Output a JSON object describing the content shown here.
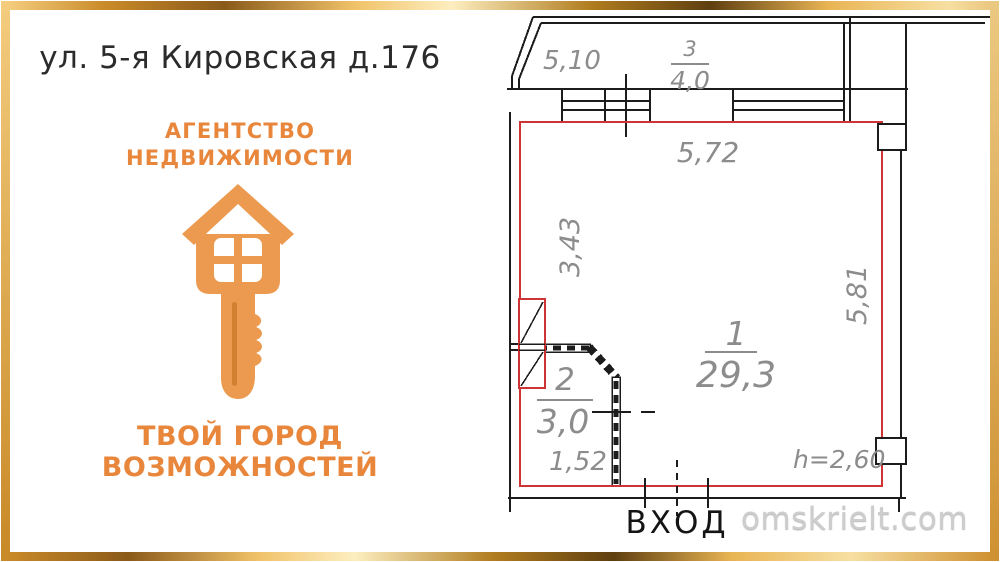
{
  "address": "ул. 5-я Кировская д.176",
  "agency": {
    "line1": "АГЕНТСТВО",
    "line2": "НЕДВИЖИМОСТИ",
    "slogan1": "ТВОЙ ГОРОД",
    "slogan2": "ВОЗМОЖНОСТЕЙ",
    "accent_color": "#e8873c",
    "logo_color": "#eb9a50"
  },
  "floorplan": {
    "outline_color": "#cf3434",
    "line_color": "#1c1c1c",
    "dim_color": "#8c8c8c",
    "rooms": [
      {
        "number": "1",
        "area": "29,3"
      },
      {
        "number": "2",
        "area": "3,0"
      },
      {
        "number": "3",
        "area": "4,0"
      }
    ],
    "dimensions": {
      "balcony_width": "5,10",
      "top": "5,72",
      "left": "3,43",
      "right": "5,81",
      "bottom_left": "1,52",
      "ceiling_height": "h=2,60"
    },
    "entrance_label": "ВХОД"
  },
  "watermark": "omskrielt.com"
}
